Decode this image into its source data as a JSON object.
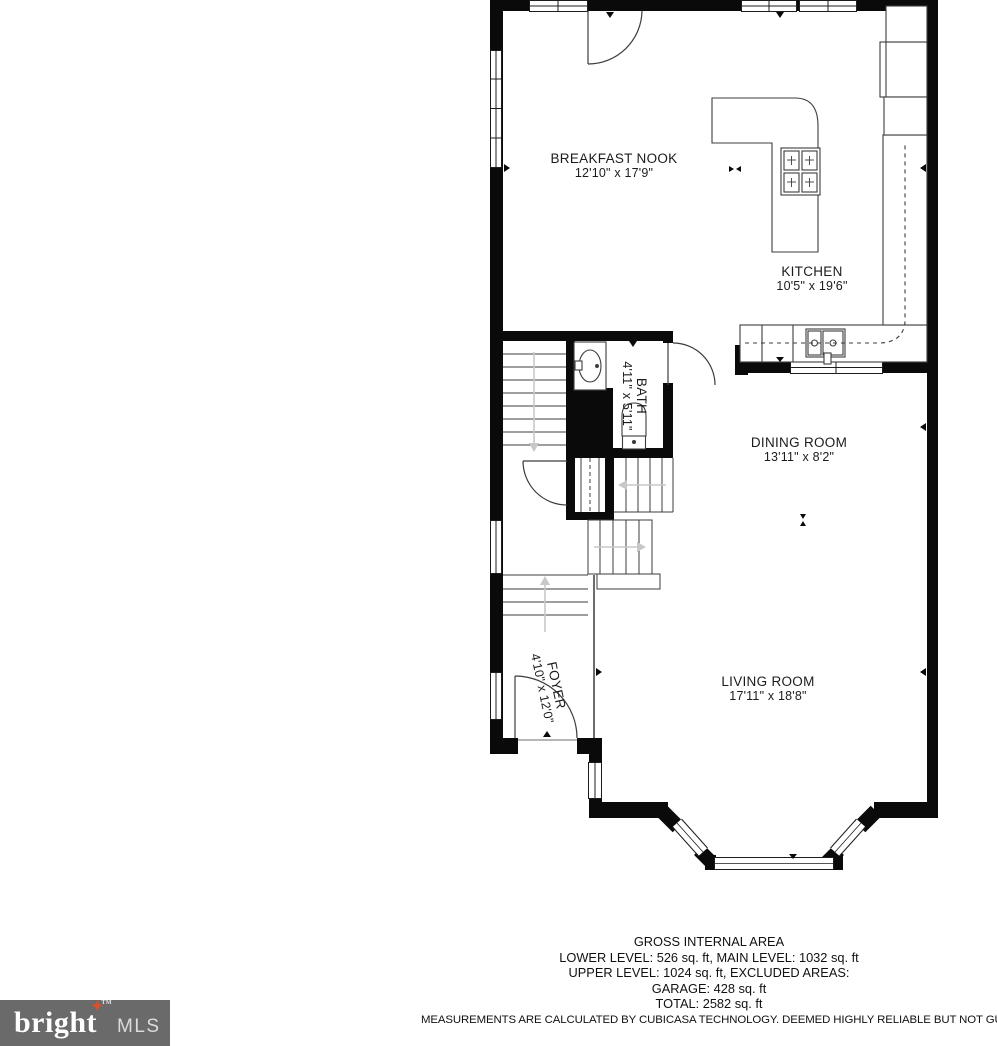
{
  "floor_plan": {
    "rooms": [
      {
        "name": "BREAKFAST NOOK",
        "dimensions": "12'10\" x 17'9\""
      },
      {
        "name": "KITCHEN",
        "dimensions": "10'5\" x 19'6\""
      },
      {
        "name": "BATH",
        "dimensions": "4'11\" x 5'11\""
      },
      {
        "name": "DINING ROOM",
        "dimensions": "13'11\" x 8'2\""
      },
      {
        "name": "FOYER",
        "dimensions": "4'10\" x 12'0\""
      },
      {
        "name": "LIVING ROOM",
        "dimensions": "17'11\" x 18'8\""
      }
    ],
    "summary": {
      "title": "GROSS INTERNAL AREA",
      "line1": "LOWER LEVEL: 526 sq. ft, MAIN LEVEL: 1032 sq. ft",
      "line2": "UPPER LEVEL: 1024 sq. ft, EXCLUDED AREAS:",
      "line3": "GARAGE: 428 sq. ft",
      "line4": "TOTAL: 2582 sq. ft",
      "disclaimer": "MEASUREMENTS ARE CALCULATED BY CUBICASA TECHNOLOGY. DEEMED HIGHLY RELIABLE BUT NOT GUARANTEED"
    },
    "colors": {
      "wall": "#0a0a0a",
      "thin_line": "#3c3c3c",
      "stair_arrow": "#c8c8c8"
    }
  },
  "logo": {
    "brand": "bright",
    "suffix": "MLS",
    "trademark": "TM",
    "star": "✦",
    "bg_color": "#6a6a6a",
    "star_color": "#d9512c"
  }
}
